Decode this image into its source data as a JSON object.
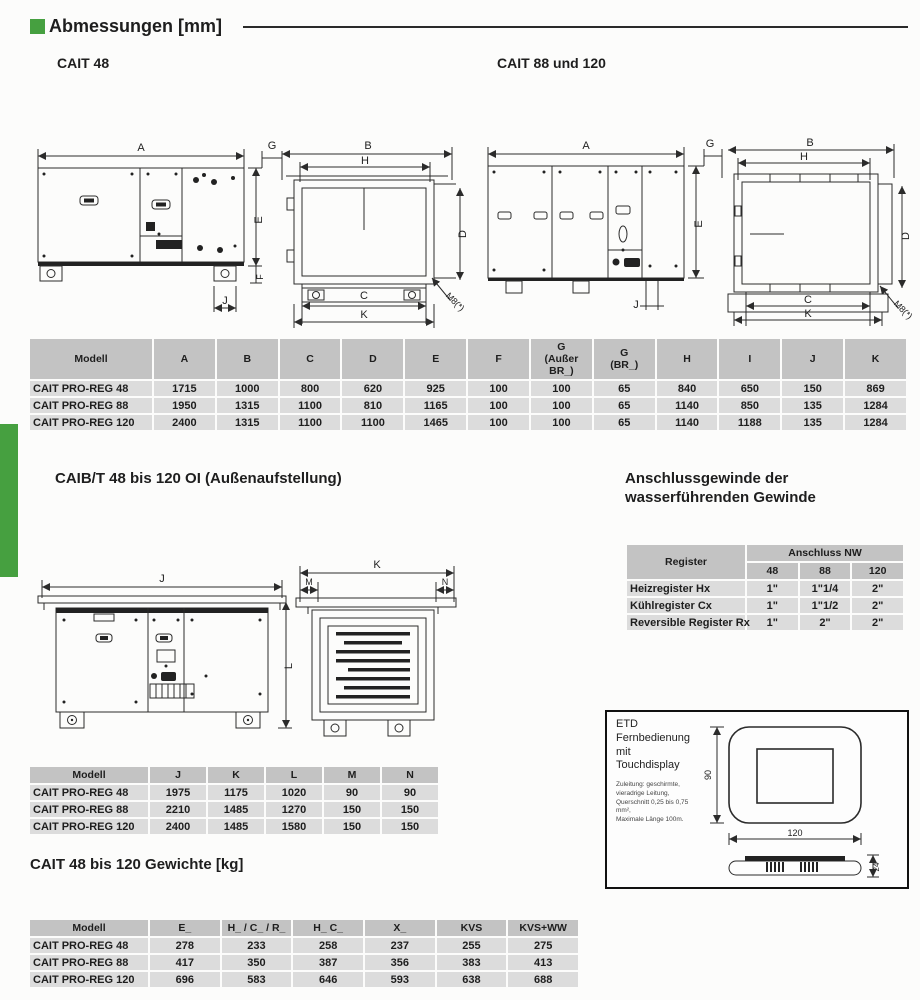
{
  "header": {
    "title": "Abmessungen [mm]",
    "accent_color": "#46a040"
  },
  "sections": {
    "cait48": "CAIT 48",
    "cait88": "CAIT 88 und 120",
    "caibt": "CAIB/T 48 bis 120 OI (Außenaufstellung)",
    "anschluss_heading": "Anschlussgewinde der\nwasserführenden Gewinde",
    "gewichte": "CAIT 48 bis 120 Gewichte [kg]"
  },
  "dim_table": {
    "headers": [
      "Modell",
      "A",
      "B",
      "C",
      "D",
      "E",
      "F",
      "G\n(Außer\nBR_)",
      "G\n(BR_)",
      "H",
      "I",
      "J",
      "K"
    ],
    "rows": [
      [
        "CAIT PRO-REG 48",
        "1715",
        "1000",
        "800",
        "620",
        "925",
        "100",
        "100",
        "65",
        "840",
        "650",
        "150",
        "869"
      ],
      [
        "CAIT PRO-REG 88",
        "1950",
        "1315",
        "1100",
        "810",
        "1165",
        "100",
        "100",
        "65",
        "1140",
        "850",
        "135",
        "1284"
      ],
      [
        "CAIT PRO-REG 120",
        "2400",
        "1315",
        "1100",
        "1100",
        "1465",
        "100",
        "100",
        "65",
        "1140",
        "1188",
        "135",
        "1284"
      ]
    ]
  },
  "outdoor_table": {
    "headers": [
      "Modell",
      "J",
      "K",
      "L",
      "M",
      "N"
    ],
    "rows": [
      [
        "CAIT PRO-REG 48",
        "1975",
        "1175",
        "1020",
        "90",
        "90"
      ],
      [
        "CAIT PRO-REG 88",
        "2210",
        "1485",
        "1270",
        "150",
        "150"
      ],
      [
        "CAIT PRO-REG 120",
        "2400",
        "1485",
        "1580",
        "150",
        "150"
      ]
    ]
  },
  "weight_table": {
    "headers": [
      "Modell",
      "E_",
      "H_ / C_ / R_",
      "H_ C_",
      "X_",
      "KVS",
      "KVS+WW"
    ],
    "rows": [
      [
        "CAIT PRO-REG 48",
        "278",
        "233",
        "258",
        "237",
        "255",
        "275"
      ],
      [
        "CAIT PRO-REG 88",
        "417",
        "350",
        "387",
        "356",
        "383",
        "413"
      ],
      [
        "CAIT PRO-REG 120",
        "696",
        "583",
        "646",
        "593",
        "638",
        "688"
      ]
    ]
  },
  "anschluss_table": {
    "register_label": "Register",
    "group_label": "Anschluss NW",
    "sizes": [
      "48",
      "88",
      "120"
    ],
    "rows": [
      {
        "label": "Heizregister Hx",
        "values": [
          "1\"",
          "1\"1/4",
          "2\""
        ]
      },
      {
        "label": "Kühlregister Cx",
        "values": [
          "1\"",
          "1\"1/2",
          "2\""
        ]
      },
      {
        "label": "Reversible Register Rx",
        "values": [
          "1\"",
          "2\"",
          "2\""
        ]
      }
    ]
  },
  "drawings": {
    "cait48_front": {
      "dim_a": "A",
      "dim_e": "E",
      "dim_f": "F",
      "dim_j": "J"
    },
    "cait48_side": {
      "dim_g": "G",
      "dim_b": "B",
      "dim_h": "H",
      "dim_d": "D",
      "dim_c": "C",
      "dim_k": "K",
      "bolt": "M8(*)"
    },
    "cait88_front": {
      "dim_a": "A",
      "dim_e": "E",
      "dim_j": "J"
    },
    "cait88_side": {
      "dim_g": "G",
      "dim_b": "B",
      "dim_h": "H",
      "dim_d": "D",
      "dim_c": "C",
      "dim_k": "K",
      "bolt": "M8(*)"
    },
    "caibt_front": {
      "dim_j": "J",
      "dim_l": "L"
    },
    "caibt_side": {
      "dim_k": "K",
      "dim_m": "M",
      "dim_n": "N"
    }
  },
  "etd": {
    "title": "ETD",
    "subtitle_line1": "Fernbedienung mit",
    "subtitle_line2": "Touchdisplay",
    "note_lines": [
      "Zuleitung: geschirmte,",
      "vieradrige Leitung,",
      "Querschnitt 0,25 bis 0,75 mm²,",
      "Maximale Länge 100m."
    ],
    "dim_height": "90",
    "dim_width": "120",
    "dim_depth": "24"
  }
}
